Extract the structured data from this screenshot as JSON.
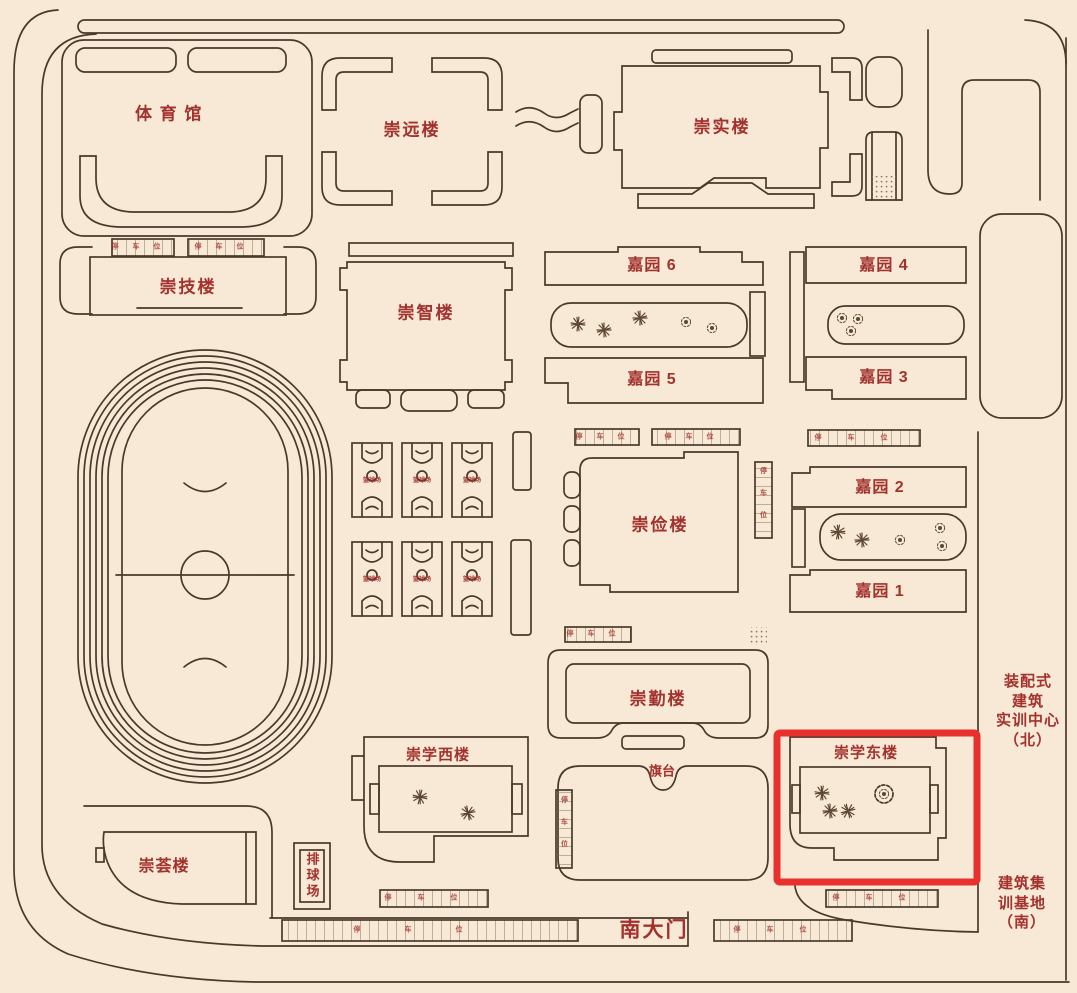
{
  "page": {
    "background": "#f7e9d6",
    "line_color": "#4a392a",
    "label_color": "#a3322e",
    "highlight_color": "#e8312f"
  },
  "buildings": {
    "gymnasium": {
      "label": "体育馆"
    },
    "chongyuan": {
      "label": "崇远楼"
    },
    "chongshi": {
      "label": "崇实楼"
    },
    "chongji": {
      "label": "崇技楼"
    },
    "chongzhi": {
      "label": "崇智楼"
    },
    "chongjian": {
      "label": "崇俭楼"
    },
    "chongqin": {
      "label": "崇勤楼"
    },
    "chongxue_west": {
      "label": "崇学西楼"
    },
    "chongxue_east": {
      "label": "崇学东楼",
      "highlighted": true
    },
    "chonghui": {
      "label": "崇荟楼"
    },
    "jiayuan6": {
      "label": "嘉园 6"
    },
    "jiayuan5": {
      "label": "嘉园 5"
    },
    "jiayuan4": {
      "label": "嘉园 4"
    },
    "jiayuan3": {
      "label": "嘉园 3"
    },
    "jiayuan2": {
      "label": "嘉园 2"
    },
    "jiayuan1": {
      "label": "嘉园 1"
    }
  },
  "facilities": {
    "basketball_court": {
      "label": "篮球场",
      "count": 6
    },
    "volleyball_court": {
      "label": "排球场"
    },
    "flag_platform": {
      "label": "旗台"
    },
    "south_gate": {
      "label": "南大门"
    },
    "parking": {
      "label": "停车位"
    },
    "training_center_north": {
      "lines": [
        "装配式",
        "建筑",
        "实训中心",
        "（北）"
      ]
    },
    "training_base_south": {
      "lines": [
        "建筑集",
        "训基地",
        "（南）"
      ]
    }
  }
}
